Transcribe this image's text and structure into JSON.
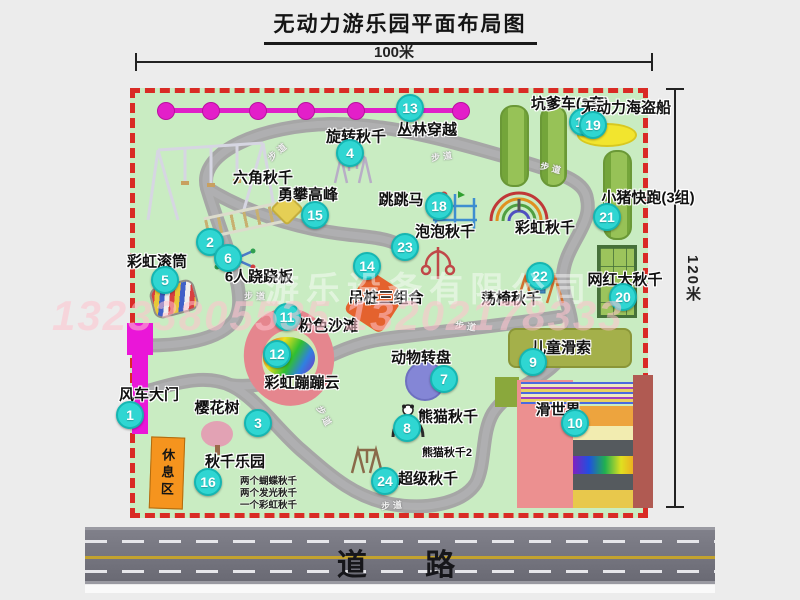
{
  "title": "无动力游乐园平面布局图",
  "dimensions": {
    "width": "100米",
    "height": "120米"
  },
  "road": {
    "label": "道 路"
  },
  "watermark": {
    "company": "游乐设备有限公司",
    "phone": "13233805535 13202178333"
  },
  "rest_area_label": "休息区",
  "walkway_label": "步道",
  "colors": {
    "park_green": "#c9ecc2",
    "border_red": "#d92b25",
    "badge_cyan": "#2fd6d2",
    "zipline_magenta": "#e020c8",
    "gate_magenta": "#ea16d8",
    "rest_orange": "#f5941e",
    "road_gray": "#74747c",
    "road_center_yellow": "#c2a22e"
  },
  "attractions": [
    {
      "num": "1",
      "label": "风车大门",
      "badge": {
        "x": -5,
        "y": 322
      },
      "label_pos": {
        "x": 14,
        "y": 301
      }
    },
    {
      "num": "2",
      "label": "六角秋千",
      "badge": {
        "x": 75,
        "y": 149
      },
      "label_pos": {
        "x": 128,
        "y": 84
      }
    },
    {
      "num": "3",
      "label": "樱花树",
      "badge": {
        "x": 123,
        "y": 330
      },
      "label_pos": {
        "x": 82,
        "y": 314
      }
    },
    {
      "num": "4",
      "label": "旋转秋千",
      "badge": {
        "x": 215,
        "y": 60
      },
      "label_pos": {
        "x": 221,
        "y": 43
      }
    },
    {
      "num": "5",
      "label": "彩虹滚筒",
      "badge": {
        "x": 30,
        "y": 187
      },
      "label_pos": {
        "x": 22,
        "y": 168
      }
    },
    {
      "num": "6",
      "label": "6人跷跷板",
      "badge": {
        "x": 93,
        "y": 165
      },
      "label_pos": {
        "x": 124,
        "y": 183
      }
    },
    {
      "num": "7",
      "label": "动物转盘",
      "badge": {
        "x": 309,
        "y": 286
      },
      "label_pos": {
        "x": 286,
        "y": 264
      }
    },
    {
      "num": "8",
      "label": "熊猫秋千",
      "badge": {
        "x": 272,
        "y": 335
      },
      "label_pos": {
        "x": 313,
        "y": 323
      }
    },
    {
      "num": "9",
      "label": "儿童滑索",
      "badge": {
        "x": 398,
        "y": 269
      },
      "label_pos": {
        "x": 426,
        "y": 254
      }
    },
    {
      "num": "10",
      "label": "滑世界",
      "badge": {
        "x": 440,
        "y": 330
      },
      "label_pos": {
        "x": 423,
        "y": 316
      }
    },
    {
      "num": "11",
      "label": "粉色沙滩",
      "badge": {
        "x": 152,
        "y": 224
      },
      "label_pos": {
        "x": 193,
        "y": 232
      }
    },
    {
      "num": "12",
      "label": "彩虹蹦蹦云",
      "badge": {
        "x": 142,
        "y": 261
      },
      "label_pos": {
        "x": 167,
        "y": 289
      }
    },
    {
      "num": "13",
      "label": "丛林穿越",
      "badge": {
        "x": 275,
        "y": 15
      },
      "label_pos": {
        "x": 292,
        "y": 36
      }
    },
    {
      "num": "14",
      "label": "吊桩三组合",
      "badge": {
        "x": 232,
        "y": 173
      },
      "label_pos": {
        "x": 251,
        "y": 204
      }
    },
    {
      "num": "15",
      "label": "勇攀高峰",
      "badge": {
        "x": 180,
        "y": 122
      },
      "label_pos": {
        "x": 173,
        "y": 101
      }
    },
    {
      "num": "16",
      "label": "秋千乐园",
      "badge": {
        "x": 73,
        "y": 389
      },
      "label_pos": {
        "x": 100,
        "y": 368
      },
      "notes": [
        "两个蝴蝶秋千",
        "两个发光秋千",
        "一个彩虹秋千"
      ],
      "notes_pos": {
        "x": 105,
        "y": 387
      }
    },
    {
      "num": "17",
      "label": "坑爹车(2套)",
      "badge": {
        "x": 448,
        "y": 29
      },
      "label_pos": {
        "x": 435,
        "y": 10
      }
    },
    {
      "num": "18",
      "label": "跳跳马",
      "badge": {
        "x": 304,
        "y": 113
      },
      "label_pos": {
        "x": 266,
        "y": 106
      }
    },
    {
      "num": "19",
      "label": "无动力海盗船",
      "badge": {
        "x": 458,
        "y": 32
      },
      "label_pos": {
        "x": 491,
        "y": 14
      }
    },
    {
      "num": "20",
      "label": "网红大秋千",
      "badge": {
        "x": 488,
        "y": 204
      },
      "label_pos": {
        "x": 490,
        "y": 186
      }
    },
    {
      "num": "21",
      "label": "小猪快跑(3组)",
      "badge": {
        "x": 472,
        "y": 124
      },
      "label_pos": {
        "x": 513,
        "y": 104
      }
    },
    {
      "num": "22",
      "label": "荡椅秋千",
      "badge": {
        "x": 405,
        "y": 183
      },
      "label_pos": {
        "x": 376,
        "y": 205
      }
    },
    {
      "num": "23",
      "label": "泡泡秋千",
      "badge": {
        "x": 270,
        "y": 154
      },
      "label_pos": {
        "x": 310,
        "y": 138
      }
    },
    {
      "num": "24",
      "label": "超级秋千",
      "badge": {
        "x": 250,
        "y": 388
      },
      "label_pos": {
        "x": 293,
        "y": 385
      }
    }
  ],
  "extra_labels": [
    {
      "text": "彩虹秋千",
      "x": 410,
      "y": 134
    },
    {
      "text": "熊猫秋千2",
      "x": 312,
      "y": 359,
      "small": true
    }
  ],
  "walkway_labels": [
    {
      "x": 143,
      "y": 58,
      "rot": -40
    },
    {
      "x": 308,
      "y": 63,
      "rot": -8
    },
    {
      "x": 417,
      "y": 75,
      "rot": 14
    },
    {
      "x": 121,
      "y": 203,
      "rot": 0
    },
    {
      "x": 332,
      "y": 233,
      "rot": 8
    },
    {
      "x": 190,
      "y": 324,
      "rot": 62
    },
    {
      "x": 258,
      "y": 412,
      "rot": -5
    }
  ]
}
